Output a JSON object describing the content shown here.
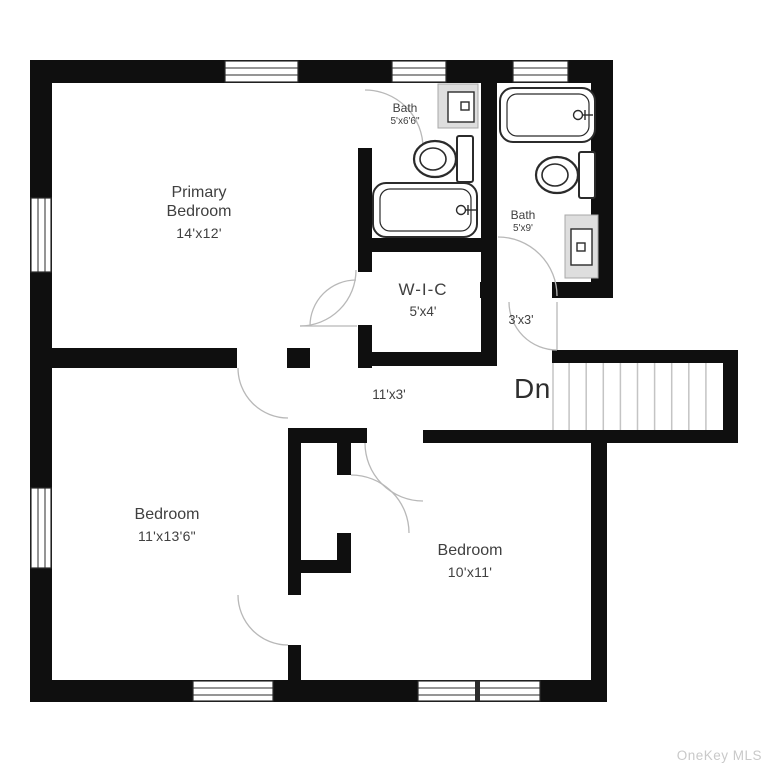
{
  "title": "Second floor plan",
  "watermark": "OneKey MLS",
  "rooms": {
    "primary_bedroom": {
      "name_line1": "Primary",
      "name_line2": "Bedroom",
      "dims": "14'x12'"
    },
    "bath_ensuite": {
      "name": "Bath",
      "dims": "5'x6'6\""
    },
    "bath_hall": {
      "name": "Bath",
      "dims": "5'x9'"
    },
    "wic": {
      "name": "W-I-C",
      "dims": "5'x4'"
    },
    "landing": {
      "dims": "3'x3'"
    },
    "hallway": {
      "dims": "11'x3'"
    },
    "bedroom_left": {
      "name": "Bedroom",
      "dims": "11'x13'6\""
    },
    "bedroom_right": {
      "name": "Bedroom",
      "dims": "10'x11'"
    }
  },
  "stairs": {
    "label": "Dn",
    "direction": "down",
    "treads": 10
  },
  "fixtures": [
    "bathtub",
    "toilet",
    "sink-vanity",
    "bathtub",
    "toilet",
    "sink-vanity"
  ],
  "colors": {
    "bg": "#ffffff",
    "wall": "#0f0f0f",
    "label": "#404040",
    "dn": "#2e2e2e",
    "door_arc": "#b8b8b8",
    "stair_tread": "#c4c4c4",
    "fixture_fill": "#ffffff",
    "fixture_stroke": "#2b2b2b",
    "vanity_fill": "#dedede",
    "vanity_border": "#a8a8a8",
    "window_frame": "#2b2b2b",
    "watermark": "#c9c9c9"
  }
}
